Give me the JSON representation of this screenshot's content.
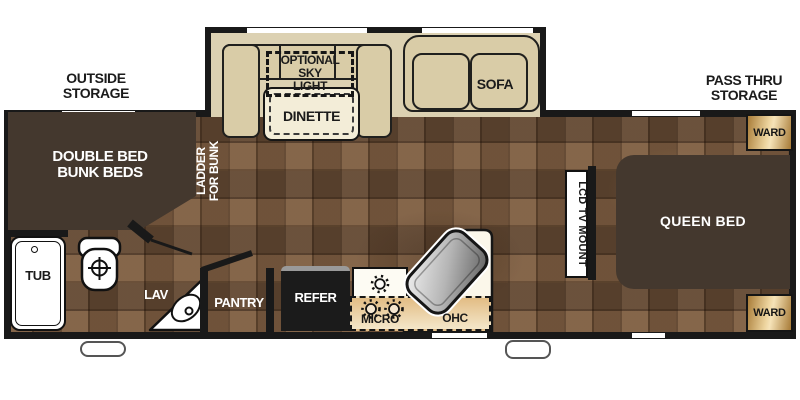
{
  "floorplan": {
    "exterior": {
      "outside_storage": [
        "OUTSIDE",
        "STORAGE"
      ],
      "pass_thru_storage": [
        "PASS THRU",
        "STORAGE"
      ]
    },
    "slideout": {
      "sky_light": [
        "OPTIONAL",
        "SKY",
        "LIGHT"
      ],
      "dinette": "DINETTE",
      "sofa": "SOFA"
    },
    "front_bedroom": {
      "bunk": [
        "DOUBLE BED",
        "BUNK BEDS"
      ],
      "ladder": [
        "LADDER",
        "FOR BUNK"
      ]
    },
    "bathroom": {
      "tub": "TUB",
      "lav": "LAV"
    },
    "kitchen": {
      "pantry": "PANTRY",
      "refer": "REFER",
      "micro": "MICRO",
      "ohc": "OHC"
    },
    "rear_bedroom": {
      "queen_bed": "QUEEN BED",
      "tv_mount": "LCD TV MOUNT",
      "ward_top": "WARD",
      "ward_bottom": "WARD"
    },
    "icons": {
      "toilet": "toilet-top-view-icon",
      "lav_sink": "corner-sink-basin-icon",
      "kitchen_sink": "angled-steel-sink-icon",
      "stove_burners": "burner-ring-icon",
      "tub_drain": "drain-icon"
    },
    "colors": {
      "wall_black": "#191919",
      "floor_brown": "#73573f",
      "slideout_tan": "#dcd1b2",
      "cushion_tan": "#d9cca7",
      "table_cream": "#f3edd8",
      "dark_furniture_brown": "#44382e",
      "ward_gold": "#edd49e",
      "counter_white": "#fbf7ea",
      "ohc_tan": "#eccfa0",
      "refer_black": "#1b1b1b",
      "sink_steel": "#b5b5b5",
      "fixture_white": "#ffffff",
      "label_dark": "#1b1b1b",
      "label_light": "#ffffff"
    }
  }
}
